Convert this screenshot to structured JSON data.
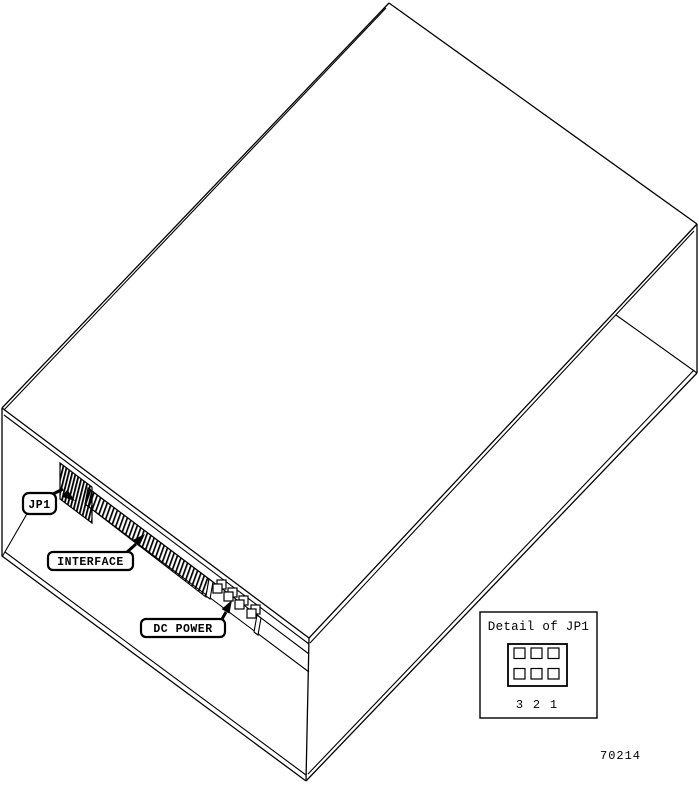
{
  "figure": {
    "background": "#ffffff",
    "line_color": "#000000",
    "description": "isometric line drawing of a disk drive enclosure with connector callouts",
    "callouts": [
      {
        "id": "jp1",
        "label": "JP1"
      },
      {
        "id": "interface",
        "label": "INTERFACE"
      },
      {
        "id": "dc-power",
        "label": "DC POWER"
      }
    ],
    "detail_inset": {
      "title": "Detail of JP1",
      "pin_labels": [
        "3",
        "2",
        "1"
      ]
    },
    "part_number": "70214"
  }
}
